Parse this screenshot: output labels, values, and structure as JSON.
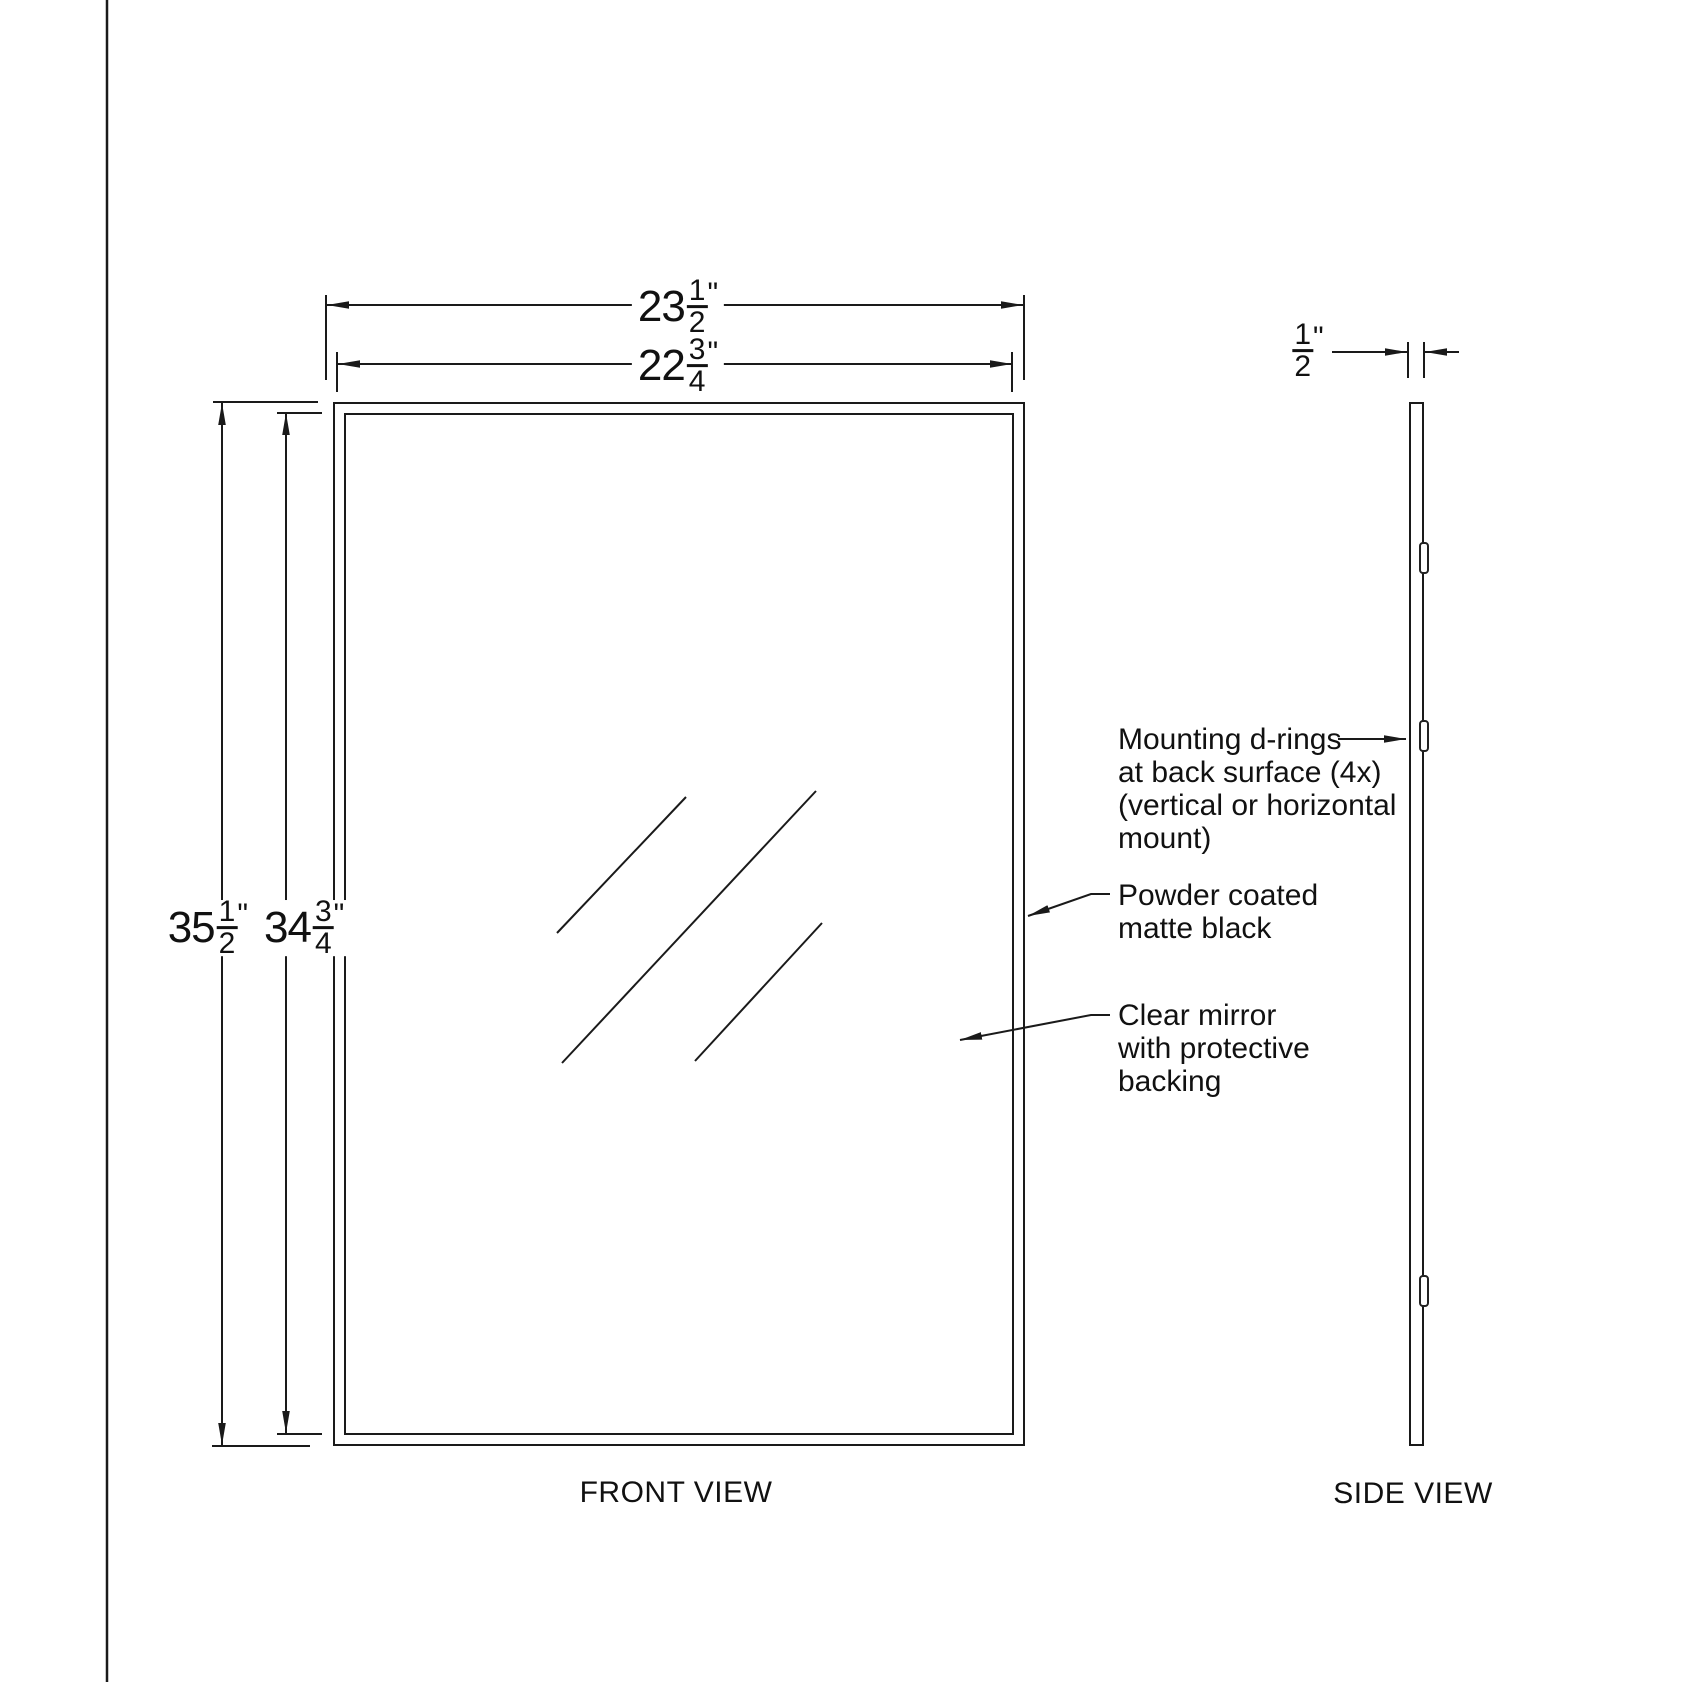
{
  "colors": {
    "line": "#1a1a1a",
    "background": "#ffffff"
  },
  "front_view": {
    "label": "FRONT VIEW",
    "outer_width": {
      "whole": "23",
      "numerator": "1",
      "denominator": "2",
      "unit": "\""
    },
    "inner_width": {
      "whole": "22",
      "numerator": "3",
      "denominator": "4",
      "unit": "\""
    },
    "outer_height": {
      "whole": "35",
      "numerator": "1",
      "denominator": "2",
      "unit": "\""
    },
    "inner_height": {
      "whole": "34",
      "numerator": "3",
      "denominator": "4",
      "unit": "\""
    }
  },
  "side_view": {
    "label": "SIDE VIEW",
    "thickness": {
      "whole": "",
      "numerator": "1",
      "denominator": "2",
      "unit": "\""
    }
  },
  "annotations": {
    "mounting_d_rings": {
      "lines": [
        "Mounting d-rings",
        "at back surface (4x)",
        "(vertical or horizontal",
        "mount)"
      ]
    },
    "powder_coating": {
      "lines": [
        "Powder coated",
        "matte black"
      ]
    },
    "clear_mirror": {
      "lines": [
        "Clear mirror",
        "with protective",
        "backing"
      ]
    }
  }
}
